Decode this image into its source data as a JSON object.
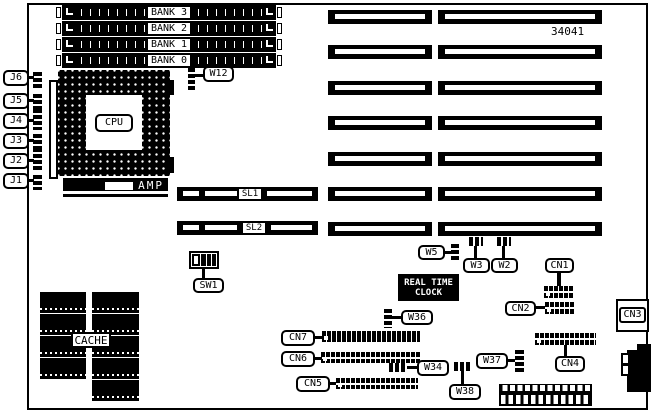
{
  "part_number": "34041",
  "memory": {
    "banks": [
      "BANK 3",
      "BANK 2",
      "BANK 1",
      "BANK 0"
    ]
  },
  "cpu": {
    "label": "CPU",
    "amp_label": "AMP"
  },
  "cache": {
    "label": "CACHE"
  },
  "rtc": {
    "line1": "REAL TIME",
    "line2": "CLOCK"
  },
  "slots": {
    "sl1": "SL1",
    "sl2": "SL2"
  },
  "switches": {
    "sw1": "SW1"
  },
  "jumpers": {
    "w12": "W12",
    "w5": "W5",
    "w3": "W3",
    "w2": "W2",
    "w36": "W36",
    "w34": "W34",
    "w37": "W37",
    "w38": "W38"
  },
  "connectors": {
    "cn1": "CN1",
    "cn2": "CN2",
    "cn3": "CN3",
    "cn4": "CN4",
    "cn5": "CN5",
    "cn6": "CN6",
    "cn7": "CN7"
  },
  "edge_connectors": {
    "j1": "J1",
    "j2": "J2",
    "j3": "J3",
    "j4": "J4",
    "j5": "J5",
    "j6": "J6"
  },
  "colors": {
    "ink": "#000000",
    "paper": "#ffffff"
  }
}
